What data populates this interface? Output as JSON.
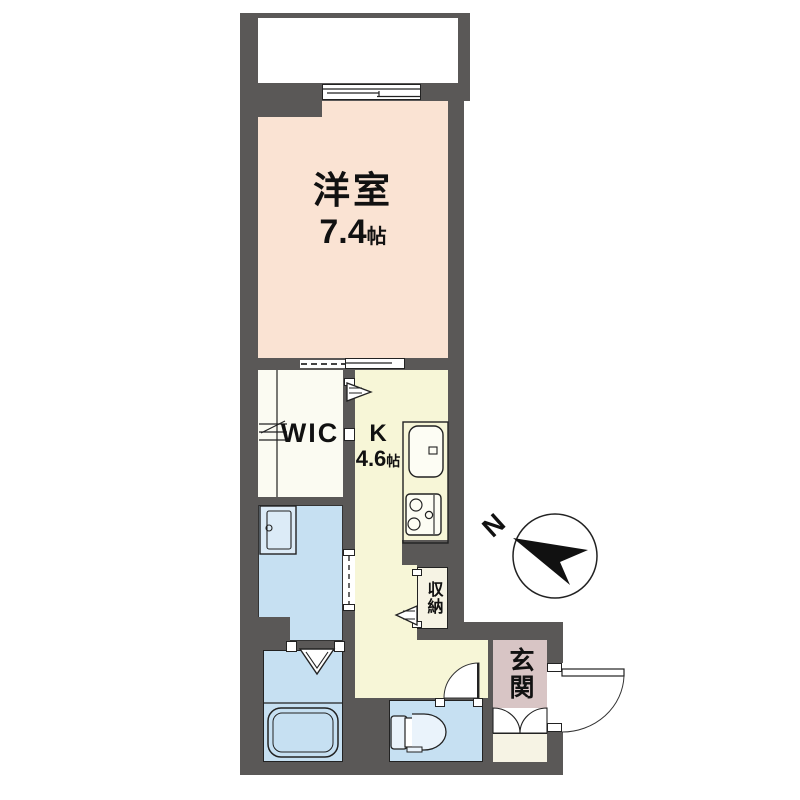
{
  "floor_plan": {
    "type": "japanese-apartment-floorplan",
    "rooms": {
      "western_room": {
        "name": "洋室",
        "area_value": "7.4",
        "area_unit": "帖"
      },
      "wic": {
        "name": "WIC"
      },
      "kitchen": {
        "name": "K",
        "area_value": "4.6",
        "area_unit": "帖"
      },
      "storage": {
        "name": "収納"
      },
      "entrance": {
        "name": "玄関"
      }
    },
    "compass": {
      "north_label": "N"
    },
    "colors": {
      "wall": "#5A5857",
      "western_room": "#FAE3D3",
      "kitchen_hall": "#F7F6D7",
      "wic": "#FBFBF2",
      "wet_rooms": "#C6E0F2",
      "entrance": "#D8C5C5",
      "storage": "#F6F3E4",
      "balcony": "#FFFFFF"
    }
  }
}
